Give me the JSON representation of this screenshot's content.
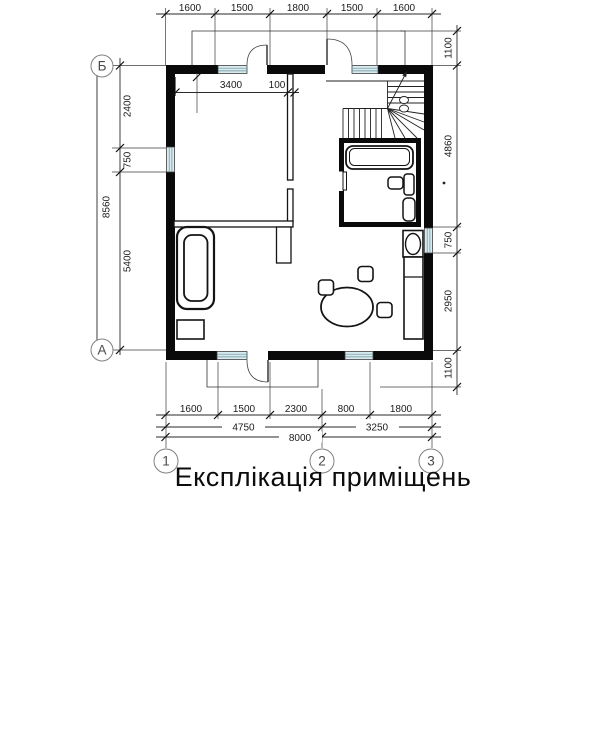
{
  "title": "Експлікація приміщень",
  "dims": {
    "top": [
      "1600",
      "1500",
      "1800",
      "1500",
      "1600"
    ],
    "interior": [
      "3400",
      "100"
    ],
    "left": [
      "2400",
      "750",
      "5400"
    ],
    "left_total": "8560",
    "right": [
      "1100",
      "4860",
      "750",
      "2950",
      "1100"
    ],
    "bottom1": [
      "1600",
      "1500",
      "2300",
      "800",
      "1800"
    ],
    "bottom2": [
      "4750",
      "3250"
    ],
    "bottom_total": "8000"
  },
  "axes": {
    "letters": [
      "Б",
      "А"
    ],
    "numbers": [
      "1",
      "2",
      "3"
    ]
  },
  "colors": {
    "wall": "#0a0a0a",
    "window_fill": "#d7ebf0",
    "line": "#1a1a1a"
  }
}
